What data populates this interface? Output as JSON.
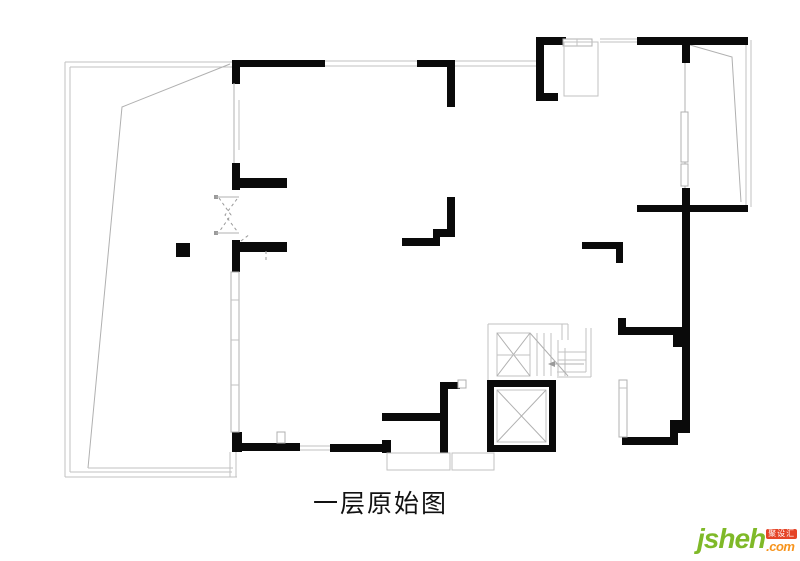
{
  "plan": {
    "title": "一层原始图",
    "colors": {
      "wall": "#0a0a0a",
      "boundary_line": "#c2c2c2",
      "detail_line": "#9a9a9a"
    }
  },
  "logo": {
    "name": "jsheh",
    "tld": ".com",
    "badge": "聚设汇",
    "colors": {
      "name": "#7fb928",
      "tld": "#f7941d",
      "badge_bg": "#e54427",
      "badge_text": "#ffffff"
    }
  }
}
